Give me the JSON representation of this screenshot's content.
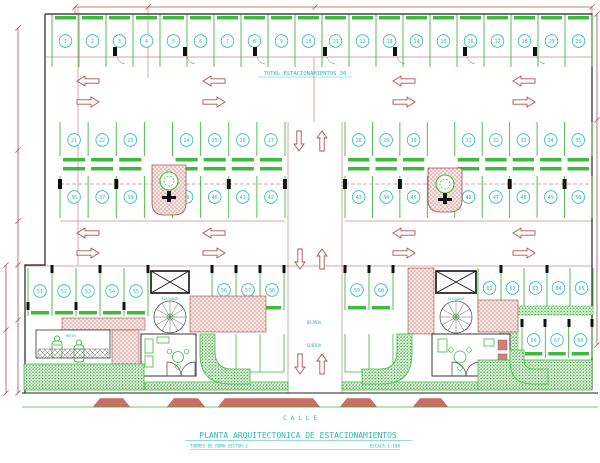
{
  "drawing": {
    "title": "PLANTA ARQUITECTONICA DE ESTACIONAMIENTOS",
    "subtitle": "TORRES DE ROMA SECTOR 1",
    "scale": "ESCALA 1:100",
    "street": "CALLE",
    "total_label": "TOTAL ESTACIONAMIENTOS 30"
  },
  "labels": {
    "elevator": "ELEVADOR",
    "motorcycles": "MOTOS",
    "ramp_down": "BAJADA",
    "ramp_up": "SUBIDA"
  },
  "colors": {
    "line_green": "#3dbb3d",
    "text_cyan": "#2ab8b8",
    "dim_red": "#b05151",
    "hatch_pink_bg": "#f6e7e5",
    "hatch_pink_dot": "#c4736d",
    "hedge_bg": "#e2f3e0",
    "hedge_dot": "#3aa93a",
    "ramp_fill": "#cd6d65",
    "wall_black": "#222222"
  },
  "stalls": {
    "row_a": [
      1,
      2,
      3,
      4,
      5,
      6,
      7,
      8,
      9,
      10,
      11,
      12,
      13,
      14,
      15,
      16,
      17,
      18,
      19,
      20
    ],
    "row_b_left": [
      21,
      22,
      23,
      24,
      25,
      26,
      27
    ],
    "row_b_right": [
      28,
      29,
      30,
      31,
      32,
      33,
      34,
      35
    ],
    "row_c_left": [
      36,
      37,
      38,
      39,
      40,
      41,
      42
    ],
    "row_c_right": [
      43,
      44,
      45,
      46,
      47,
      48,
      49,
      50
    ],
    "row_d_left": [
      51,
      52,
      53,
      54,
      55
    ],
    "row_d_center_left": [
      56,
      57,
      58
    ],
    "row_d_center_right": [
      59,
      60
    ],
    "row_d_right_top": [
      61,
      62,
      63,
      64,
      65
    ],
    "row_d_right_bottom": [
      66,
      67,
      68
    ]
  }
}
